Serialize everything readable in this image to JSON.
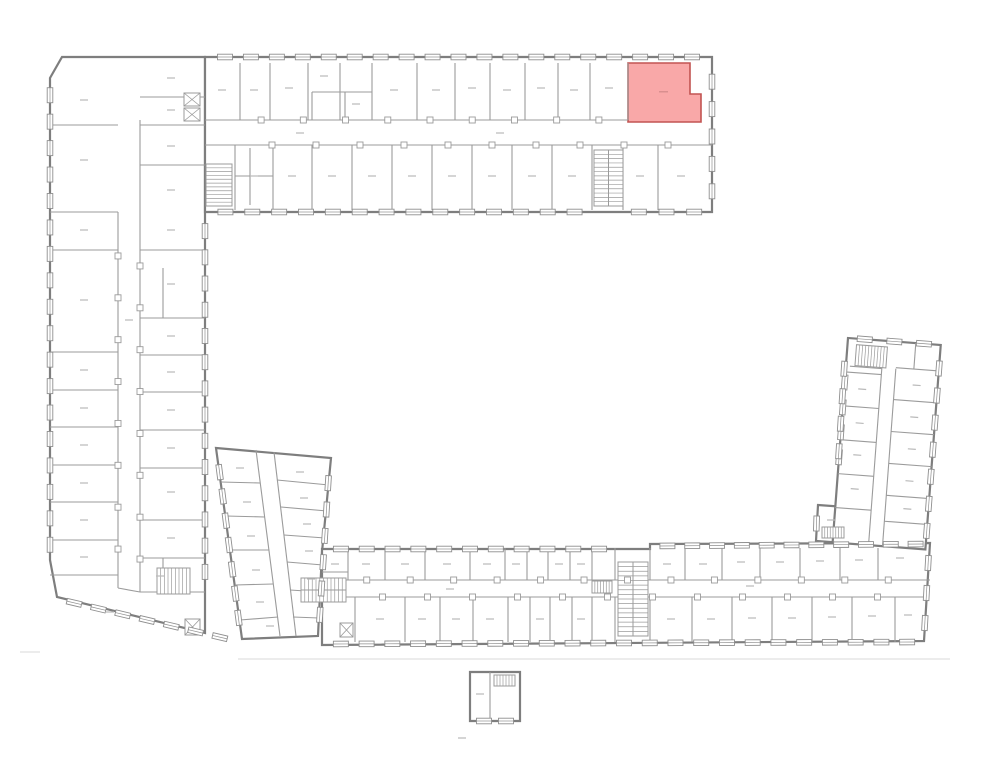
{
  "page": {
    "width": 1000,
    "height": 777,
    "background": "#ffffff"
  },
  "plan": {
    "kind": "architectural-floor-plan",
    "highlighted_unit": {
      "label": "",
      "fill": "#f9a8a8",
      "stroke": "#c25452"
    },
    "colors": {
      "outer_wall": "#7e7e7e",
      "partition": "#9b9b9b",
      "detail": "#bcbcbc",
      "window_frame": "#8f8f8f",
      "label_dash": "#b9b9b9",
      "property_line": "#dadada",
      "stair": "#9b9b9b",
      "room_fill": "#ffffff"
    },
    "features": {
      "stairwells": 9,
      "elevators": 4,
      "wings": [
        "top-wing",
        "left-wing",
        "tilted-annex",
        "bottom-wing",
        "right-wing",
        "outbuilding"
      ]
    }
  }
}
